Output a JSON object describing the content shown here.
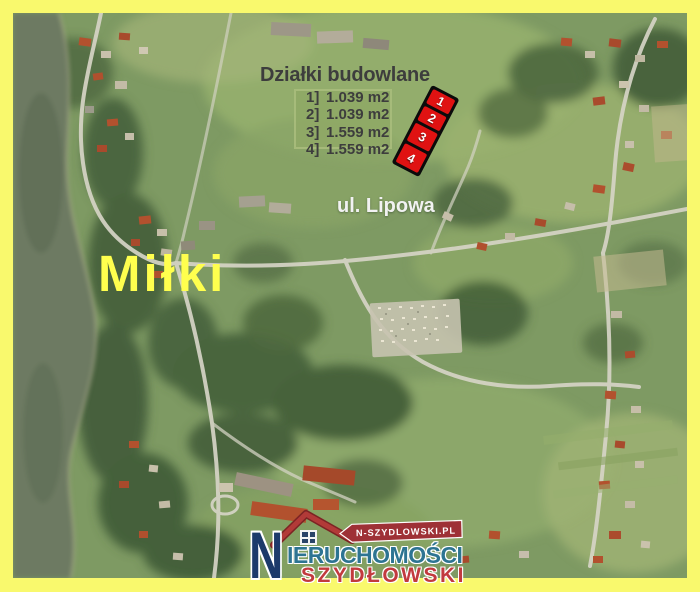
{
  "listing": {
    "title": "Działki budowlane",
    "plots": [
      {
        "num": "1]",
        "area": "1.039 m2",
        "marker": "1"
      },
      {
        "num": "2]",
        "area": "1.039 m2",
        "marker": "2"
      },
      {
        "num": "3]",
        "area": "1.559 m2",
        "marker": "3"
      },
      {
        "num": "4]",
        "area": "1.559 m2",
        "marker": "4"
      }
    ],
    "street_label": "ul. Lipowa",
    "town_label": "Miłki"
  },
  "logo": {
    "website": "N-SZYDLOWSKI.PL",
    "brand_initial": "N",
    "brand_name_rest": "IERUCHOMOŚCI",
    "brand_surname": "SZYDŁOWSKI"
  },
  "colors": {
    "frame_border": "#f9f96d",
    "plot_marker_fill": "#e01212",
    "plot_marker_border": "#0b0b0b",
    "town_label": "#ffff4e",
    "street_label": "#f2f2f2",
    "listing_text": "#3d3d3d",
    "logo_navy": "#1c3a6b",
    "logo_teal": "#2d7492",
    "logo_red": "#c23a3e",
    "banner_red": "#9e3136"
  }
}
